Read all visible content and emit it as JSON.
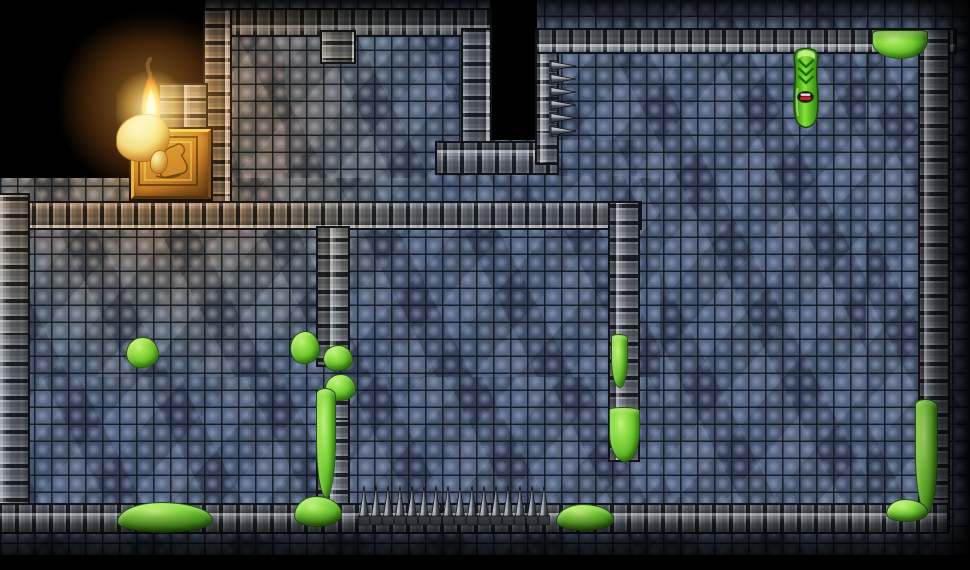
{
  "scene": {
    "width": 970,
    "height": 570,
    "background": "#000000"
  },
  "palette": {
    "floor_base": "#46536d",
    "floor_light": "#6d81a4",
    "floor_dark": "#333c50",
    "grout": "#161c29",
    "wall_face": "#7b818c",
    "wall_light": "#9aa0aa",
    "wall_seam": "#23262c",
    "slime": "#62bc28",
    "slime_light": "#c2f17e",
    "slime_dark": "#3d8414",
    "flame_core": "#fff6d0",
    "flame_mid": "#ffd84a",
    "flame_outer": "#e85c0c",
    "gold_light": "#cfa953",
    "gold_dark": "#55431c",
    "wax": "#dcce9c",
    "metal_light": "#dde1e8",
    "metal_dark": "#282b31"
  },
  "floors": [
    {
      "name": "top-room-floor",
      "x": 205,
      "y": 0,
      "w": 285,
      "h": 228
    },
    {
      "name": "right-area-floor",
      "x": 537,
      "y": 0,
      "w": 433,
      "h": 555
    },
    {
      "name": "lower-rooms-floor",
      "x": 0,
      "y": 178,
      "w": 660,
      "h": 377
    },
    {
      "name": "passage-floor",
      "x": 437,
      "y": 140,
      "w": 200,
      "h": 88
    }
  ],
  "walls": [
    {
      "name": "top-room-north-wall",
      "x": 205,
      "y": 10,
      "w": 285,
      "h": 25,
      "dir": "h"
    },
    {
      "name": "top-room-west-wall",
      "x": 205,
      "y": 10,
      "w": 25,
      "h": 196,
      "dir": "v"
    },
    {
      "name": "top-room-door-stub",
      "x": 322,
      "y": 32,
      "w": 32,
      "h": 30,
      "dir": "v"
    },
    {
      "name": "top-room-east-wall",
      "x": 463,
      "y": 30,
      "w": 27,
      "h": 132,
      "dir": "v"
    },
    {
      "name": "passage-north-wall",
      "x": 437,
      "y": 143,
      "w": 120,
      "h": 30,
      "dir": "h"
    },
    {
      "name": "right-room-west-wall",
      "x": 537,
      "y": 30,
      "w": 20,
      "h": 133,
      "dir": "v"
    },
    {
      "name": "right-room-north-wall",
      "x": 537,
      "y": 30,
      "w": 418,
      "h": 22,
      "dir": "h"
    },
    {
      "name": "right-room-east-wall",
      "x": 920,
      "y": 30,
      "w": 28,
      "h": 500,
      "dir": "v"
    },
    {
      "name": "central-wall",
      "x": 0,
      "y": 203,
      "w": 640,
      "h": 25,
      "dir": "h"
    },
    {
      "name": "west-outer-wall",
      "x": 0,
      "y": 195,
      "w": 28,
      "h": 335,
      "dir": "v"
    },
    {
      "name": "left-divider-upper",
      "x": 318,
      "y": 228,
      "w": 30,
      "h": 137,
      "dir": "v"
    },
    {
      "name": "left-divider-lower",
      "x": 318,
      "y": 392,
      "w": 30,
      "h": 140,
      "dir": "v"
    },
    {
      "name": "right-divider",
      "x": 610,
      "y": 203,
      "w": 28,
      "h": 257,
      "dir": "v"
    },
    {
      "name": "south-wall",
      "x": 0,
      "y": 505,
      "w": 947,
      "h": 27,
      "dir": "h"
    },
    {
      "name": "torch-alcove-wall",
      "x": 160,
      "y": 85,
      "w": 46,
      "h": 50,
      "dir": "v"
    }
  ],
  "torch": {
    "pedestal": {
      "x": 131,
      "y": 129,
      "w": 74,
      "h": 64
    },
    "wax": {
      "x": 116,
      "y": 114,
      "w": 52,
      "h": 46
    },
    "wax_drip": {
      "x": 150,
      "y": 150,
      "w": 16,
      "h": 22
    },
    "flame": {
      "x": 133,
      "y": 56,
      "w": 36,
      "h": 90
    }
  },
  "creature": {
    "name": "green-worm-creature",
    "x": 789,
    "y": 46,
    "w": 34,
    "h": 84
  },
  "slimes": [
    {
      "name": "wall-slime-top-right",
      "x": 872,
      "y": 30,
      "w": 54,
      "h": 27,
      "shape": "cap"
    },
    {
      "name": "floor-slime-left-room",
      "x": 126,
      "y": 337,
      "w": 31,
      "h": 29,
      "shape": "blob"
    },
    {
      "name": "doorway-slime-a",
      "x": 290,
      "y": 331,
      "w": 28,
      "h": 31,
      "shape": "blob"
    },
    {
      "name": "doorway-slime-b",
      "x": 323,
      "y": 345,
      "w": 28,
      "h": 24,
      "shape": "blob"
    },
    {
      "name": "doorway-slime-c",
      "x": 325,
      "y": 374,
      "w": 29,
      "h": 25,
      "shape": "blob"
    },
    {
      "name": "divider-slime-drip-left",
      "x": 316,
      "y": 388,
      "w": 18,
      "h": 108,
      "shape": "drip"
    },
    {
      "name": "divider-slime-pool-left",
      "x": 294,
      "y": 496,
      "w": 46,
      "h": 29,
      "shape": "pool"
    },
    {
      "name": "right-divider-slime-drip",
      "x": 611,
      "y": 334,
      "w": 15,
      "h": 52,
      "shape": "drip"
    },
    {
      "name": "right-divider-slime-blob",
      "x": 609,
      "y": 407,
      "w": 29,
      "h": 53,
      "shape": "drip"
    },
    {
      "name": "south-wall-slime-mid",
      "x": 556,
      "y": 504,
      "w": 56,
      "h": 25,
      "shape": "pool"
    },
    {
      "name": "south-wall-slime-west",
      "x": 117,
      "y": 502,
      "w": 94,
      "h": 29,
      "shape": "pool"
    },
    {
      "name": "east-wall-slime-drip",
      "x": 915,
      "y": 399,
      "w": 21,
      "h": 113,
      "shape": "drip"
    },
    {
      "name": "east-corner-slime-pool",
      "x": 886,
      "y": 499,
      "w": 40,
      "h": 21,
      "shape": "pool"
    }
  ],
  "spike_rows": [
    {
      "name": "floor-spike-row",
      "type": "up",
      "x": 358,
      "y": 484,
      "count": 16,
      "spacing": 12
    },
    {
      "name": "wall-spike-row",
      "type": "right",
      "x": 549,
      "y": 60,
      "count": 6,
      "spacing": 13
    }
  ],
  "light_overlays": [
    {
      "name": "torch-glow-main",
      "kind": "light-main",
      "x": -130,
      "y": -155,
      "w": 570,
      "h": 560
    },
    {
      "name": "torch-glow-core",
      "kind": "light-core",
      "x": 56,
      "y": 8,
      "w": 190,
      "h": 190
    },
    {
      "name": "torch-glow-hot",
      "kind": "light-hot",
      "x": 116,
      "y": 66,
      "w": 70,
      "h": 84
    }
  ],
  "shadow_overlays": [
    {
      "name": "top-darkness",
      "kind": "shade-top",
      "x": 0,
      "y": 0,
      "w": 970,
      "h": 42
    },
    {
      "name": "right-darkness",
      "kind": "shade-right",
      "x": 912,
      "y": 0,
      "w": 58,
      "h": 570
    },
    {
      "name": "bottom-darkness",
      "kind": "shade-bottom",
      "x": 0,
      "y": 510,
      "w": 970,
      "h": 60
    }
  ]
}
